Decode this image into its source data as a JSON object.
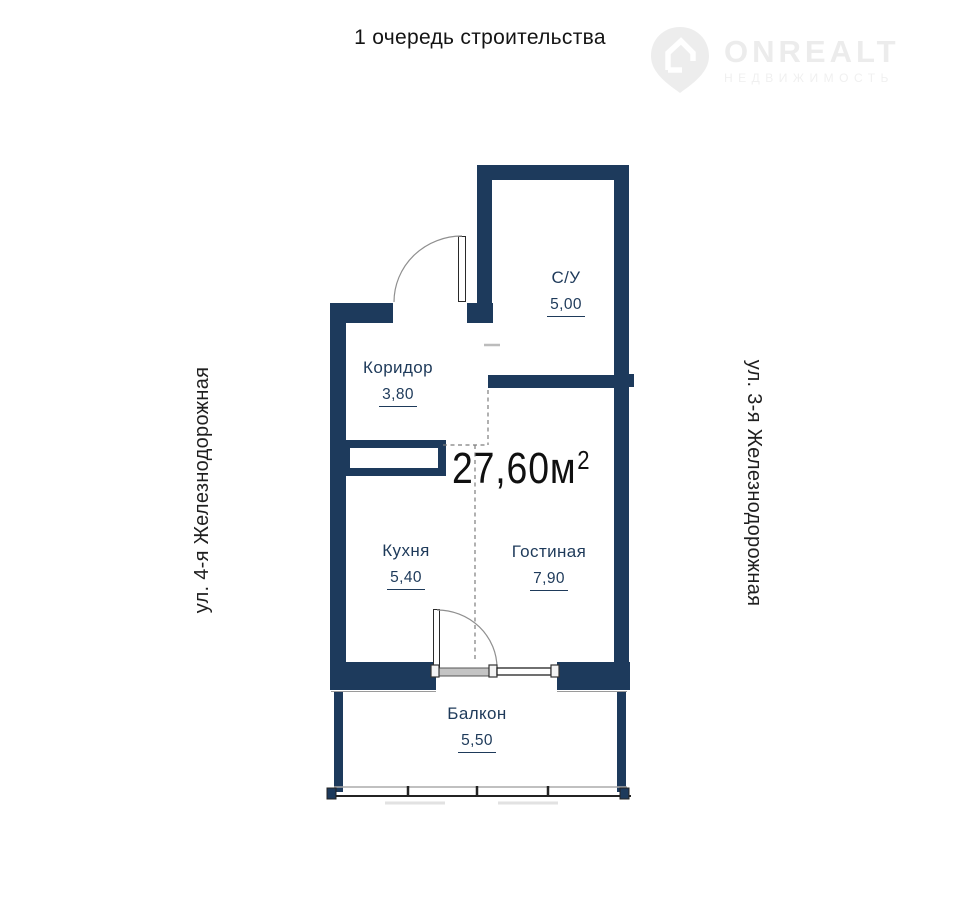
{
  "title": "1 очередь строительства",
  "logo": {
    "brand": "ONREALT",
    "tagline": "НЕДВИЖИМОСТЬ"
  },
  "streets": {
    "left": "ул. 4-я Железнодорожная",
    "right": "ул. 3-я Железнодорожная"
  },
  "total_area": {
    "value": "27,60м",
    "superscript": "2"
  },
  "rooms": {
    "bathroom": {
      "label": "С/У",
      "area": "5,00"
    },
    "corridor": {
      "label": "Коридор",
      "area": "3,80"
    },
    "kitchen": {
      "label": "Кухня",
      "area": "5,40"
    },
    "living": {
      "label": "Гостиная",
      "area": "7,90"
    },
    "balcony": {
      "label": "Балкон",
      "area": "5,50"
    }
  },
  "colors": {
    "wall": "#1d3a5c",
    "room_label": "#1e3a5a",
    "area_text": "#101010",
    "watermark": "#ececec"
  }
}
